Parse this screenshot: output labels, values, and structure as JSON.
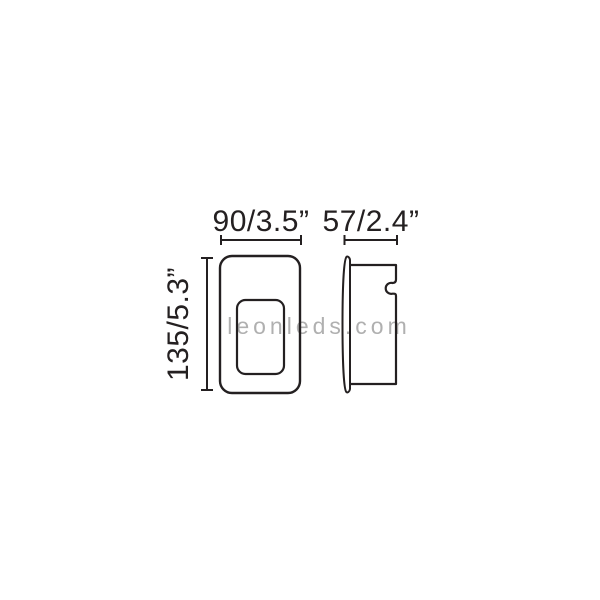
{
  "page": {
    "background_color": "#ffffff"
  },
  "watermark": {
    "text": "leonleds.com",
    "color": "#b0b0b0"
  },
  "diagram": {
    "stroke_color": "#242021",
    "labels": {
      "front_width": "90/3.5”",
      "side_depth": "57/2.4”",
      "front_height": "135/5.3”"
    }
  }
}
